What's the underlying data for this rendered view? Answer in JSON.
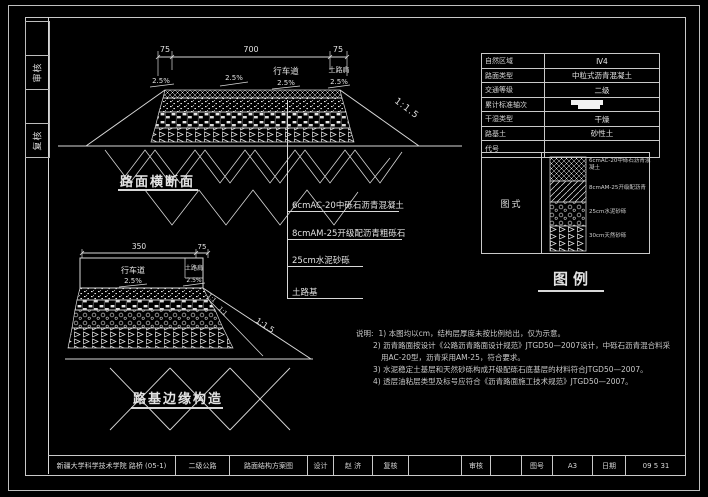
{
  "colors": {
    "background": "#000000",
    "line": "#d8d8d8",
    "text": "#e6e6e6"
  },
  "stamps": {
    "items": [
      "",
      "审核",
      "",
      "复核"
    ]
  },
  "top_section": {
    "title": "路面横断面",
    "dim_left": "75",
    "dim_center": "700",
    "dim_right": "75",
    "lane_label": "行车道",
    "lane_slope": "2.5%",
    "shoulder_label": "土路肩",
    "shoulder_slope": "2.5%",
    "left_slope": "2.5%",
    "mid_slope": "2.5%",
    "side_slope": "1:1.5"
  },
  "callouts": {
    "items": [
      "6cmAC-20中砾石沥青混凝土",
      "8cmAM-25开级配沥青粗砾石",
      "25cm水泥砂砾",
      "土路基"
    ]
  },
  "edge_section": {
    "title": "路基边缘构造",
    "dim_left": "350",
    "dim_right": "75",
    "lane_label": "行车道",
    "lane_slope": "2.5%",
    "shoulder_label": "土路肩",
    "shoulder_slope": "2.5%",
    "slope_1": "1:1",
    "slope_2": "1:1",
    "side_slope": "1:1.5"
  },
  "info_table": {
    "rows": [
      {
        "label": "自然区域",
        "value": "Ⅳ4"
      },
      {
        "label": "路面类型",
        "value": "中粒式沥青混凝土"
      },
      {
        "label": "交通等级",
        "value": "二级"
      },
      {
        "label": "累计标准轴次",
        "value": ""
      },
      {
        "label": "干湿类型",
        "value": "干燥"
      },
      {
        "label": "路基土",
        "value": "砂性土"
      },
      {
        "label": "代号",
        "value": ""
      }
    ],
    "diagram_label": "图式",
    "legend_title": "图例",
    "legend_layers": [
      "6cmAC-20中砾石沥青混凝土",
      "8cmAM-25开级配沥青",
      "25cm水泥砂砾",
      "30cm天然砂砾"
    ]
  },
  "notes": {
    "heading": "说明:",
    "lines": [
      "1) 本图均以cm，结构层厚度未按比例给出，仅为示意。",
      "2) 沥青路面按设计《公路沥青路面设计规范》JTGD50—2007设计，中砾石沥青混合料采",
      "用AC-20型，沥青采用AM-25，符合要求。",
      "3) 水泥稳定土基层和天然砂砾构成开级配砾石底基层的材料符合JTGD50—2007。",
      "4) 透层油粘层类型及标号应符合《沥青路面施工技术规范》JTGD50—2007。"
    ]
  },
  "title_bar": {
    "cells": [
      "新疆大学科学技术学院 路桥 (05-1)",
      "二级公路",
      "路面结构方案图",
      "设计",
      "赵 济",
      "复核",
      "",
      "审核",
      "",
      "图号",
      "A3",
      "日期",
      "09 5 31"
    ]
  }
}
